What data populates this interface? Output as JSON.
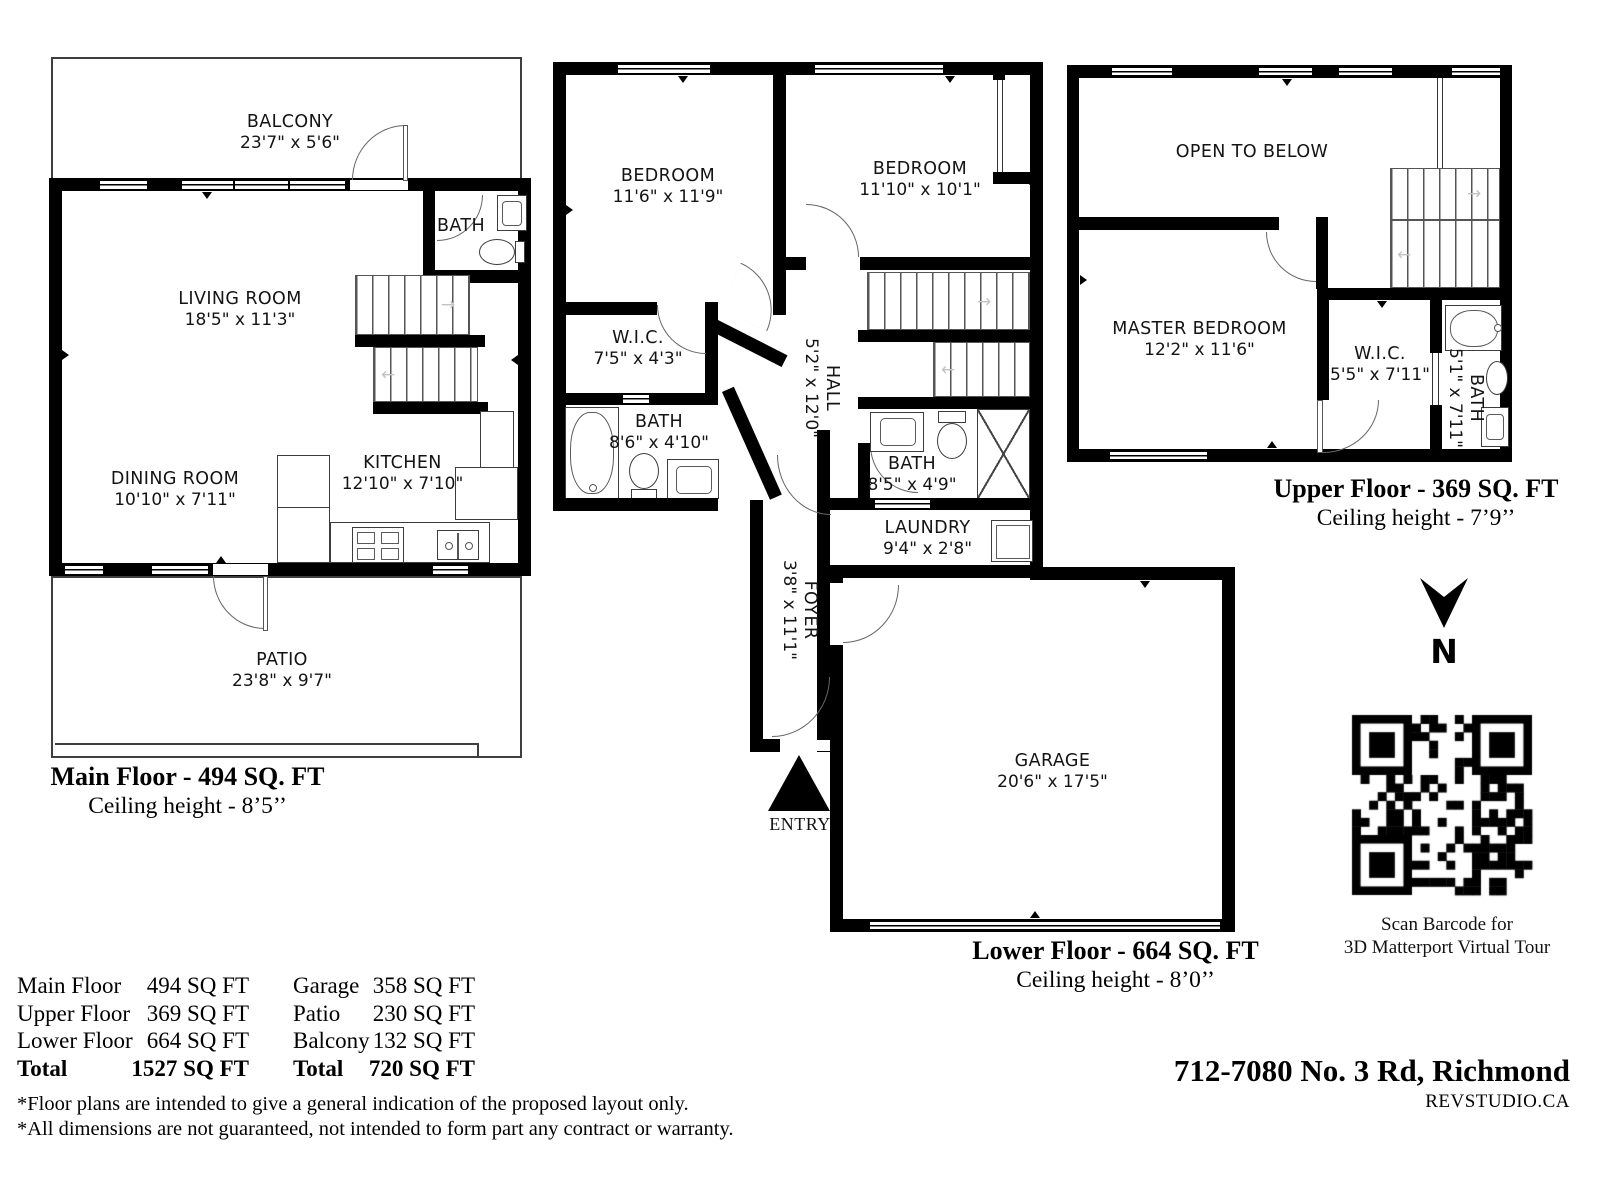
{
  "plans": {
    "main": {
      "caption": "Main Floor - 494 SQ. FT",
      "ceiling": "Ceiling height - 8’5’’",
      "rooms": {
        "balcony": {
          "name": "BALCONY",
          "dims": "23'7\" x 5'6\""
        },
        "bath": {
          "name": "BATH"
        },
        "living": {
          "name": "LIVING ROOM",
          "dims": "18'5\" x 11'3\""
        },
        "dining": {
          "name": "DINING ROOM",
          "dims": "10'10\" x 7'11\""
        },
        "kitchen": {
          "name": "KITCHEN",
          "dims": "12'10\" x 7'10\""
        },
        "patio": {
          "name": "PATIO",
          "dims": "23'8\" x 9'7\""
        }
      }
    },
    "lower": {
      "caption": "Lower Floor - 664 SQ. FT",
      "ceiling": "Ceiling height - 8’0’’",
      "entry_label": "ENTRY",
      "rooms": {
        "bedroom1": {
          "name": "BEDROOM",
          "dims": "11'6\" x 11'9\""
        },
        "bedroom2": {
          "name": "BEDROOM",
          "dims": "11'10\" x 10'1\""
        },
        "wic": {
          "name": "W.I.C.",
          "dims": "7'5\" x 4'3\""
        },
        "bath1": {
          "name": "BATH",
          "dims": "8'6\" x 4'10\""
        },
        "hall": {
          "name": "HALL",
          "dims": "5'2\" x 12'0\""
        },
        "bath2": {
          "name": "BATH",
          "dims": "8'5\" x 4'9\""
        },
        "laundry": {
          "name": "LAUNDRY",
          "dims": "9'4\" x 2'8\""
        },
        "foyer": {
          "name": "FOYER",
          "dims": "3'8\" x 11'1\""
        },
        "garage": {
          "name": "GARAGE",
          "dims": "20'6\" x 17'5\""
        }
      }
    },
    "upper": {
      "caption": "Upper Floor - 369 SQ. FT",
      "ceiling": "Ceiling height - 7’9’’",
      "rooms": {
        "open": {
          "name": "OPEN TO BELOW"
        },
        "master": {
          "name": "MASTER BEDROOM",
          "dims": "12'2\" x 11'6\""
        },
        "wic": {
          "name": "W.I.C.",
          "dims": "5'5\" x 7'11\""
        },
        "bath": {
          "name": "BATH",
          "dims": "5'1\" x 7'11\""
        }
      }
    }
  },
  "compass": {
    "label": "N"
  },
  "qr": {
    "line1": "Scan Barcode for",
    "line2": "3D Matterport Virtual Tour"
  },
  "summary": {
    "left": [
      {
        "label": "Main Floor",
        "value": "494 SQ FT"
      },
      {
        "label": "Upper Floor",
        "value": "369 SQ FT"
      },
      {
        "label": "Lower Floor",
        "value": "664 SQ FT"
      },
      {
        "label": "Total",
        "value": "1527 SQ FT"
      }
    ],
    "right": [
      {
        "label": "Garage",
        "value": "358 SQ FT"
      },
      {
        "label": "Patio",
        "value": "230 SQ FT"
      },
      {
        "label": "Balcony",
        "value": "132 SQ FT"
      },
      {
        "label": "Total",
        "value": "720 SQ FT"
      }
    ]
  },
  "disclaimers": [
    "*Floor plans are intended to give a general indication of the proposed layout only.",
    "*All dimensions are not guaranteed, not intended to form part any contract or warranty."
  ],
  "footer": {
    "address": "712-7080 No. 3 Rd, Richmond",
    "brand": "REVSTUDIO.CA"
  }
}
